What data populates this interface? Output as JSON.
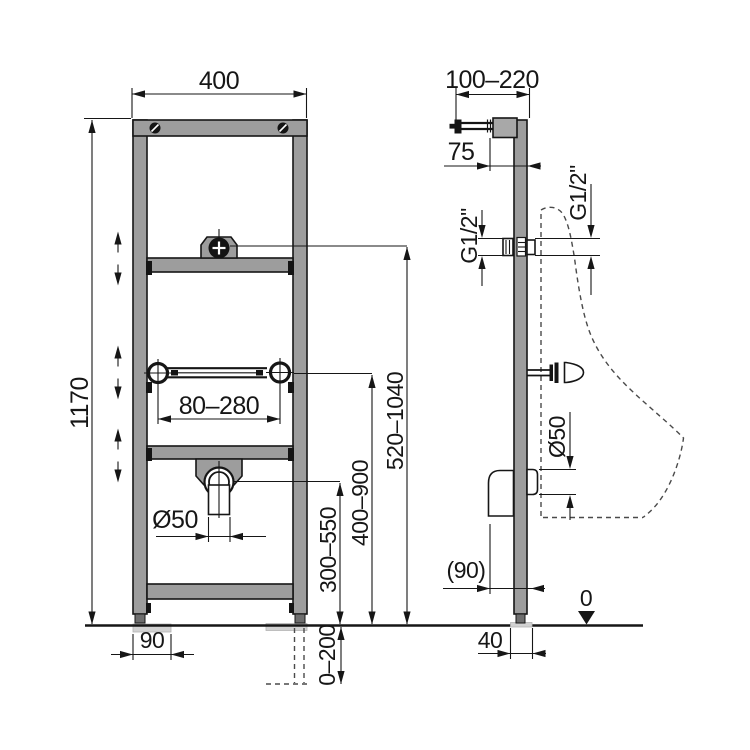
{
  "drawing": {
    "type": "installation-frame-technical-drawing",
    "views": [
      "front",
      "side"
    ],
    "colors": {
      "frame_gray": "#9d9d9d",
      "outline": "#161616",
      "foot_pad_gray": "#d2d2d2",
      "dashed_outline": "#4a4a4a",
      "background": "#ffffff"
    },
    "labels": {
      "front": {
        "width": "400",
        "height": "1170",
        "rail_span": "80–280",
        "drain_diameter": "Ø50",
        "inlet_height": "520–1040",
        "rail_height": "400–900",
        "drain_height": "300–550",
        "leg_extension": "0–200",
        "foot_plate_width": "90"
      },
      "side": {
        "arm_depth_range": "100–220",
        "inlet_offset": "75",
        "thread_left": "G1/2\"",
        "thread_right": "G1/2\"",
        "drain_diameter": "Ø50",
        "drain_offset": "(90)",
        "profile_depth": "40",
        "floor_datum": "0"
      }
    }
  }
}
